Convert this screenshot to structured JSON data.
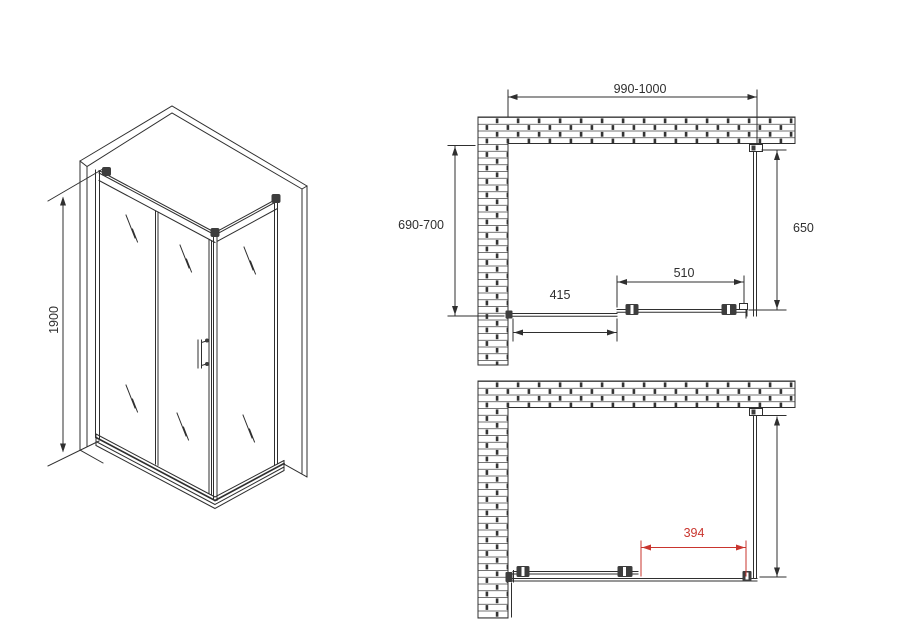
{
  "drawing_title": "shower-enclosure-technical-drawing",
  "colors": {
    "line": "#2f2f2f",
    "dark": "#3d3d3d",
    "red": "#c9352e",
    "bg": "#ffffff"
  },
  "isometric_view": {
    "height_dim": "1900"
  },
  "plan_view_closed": {
    "width_dim": "990-1000",
    "depth_dim": "690-700",
    "side_panel_dim": "650",
    "door_dim": "510",
    "fixed_panel_dim": "415"
  },
  "plan_view_open": {
    "opening_dim": "394"
  }
}
